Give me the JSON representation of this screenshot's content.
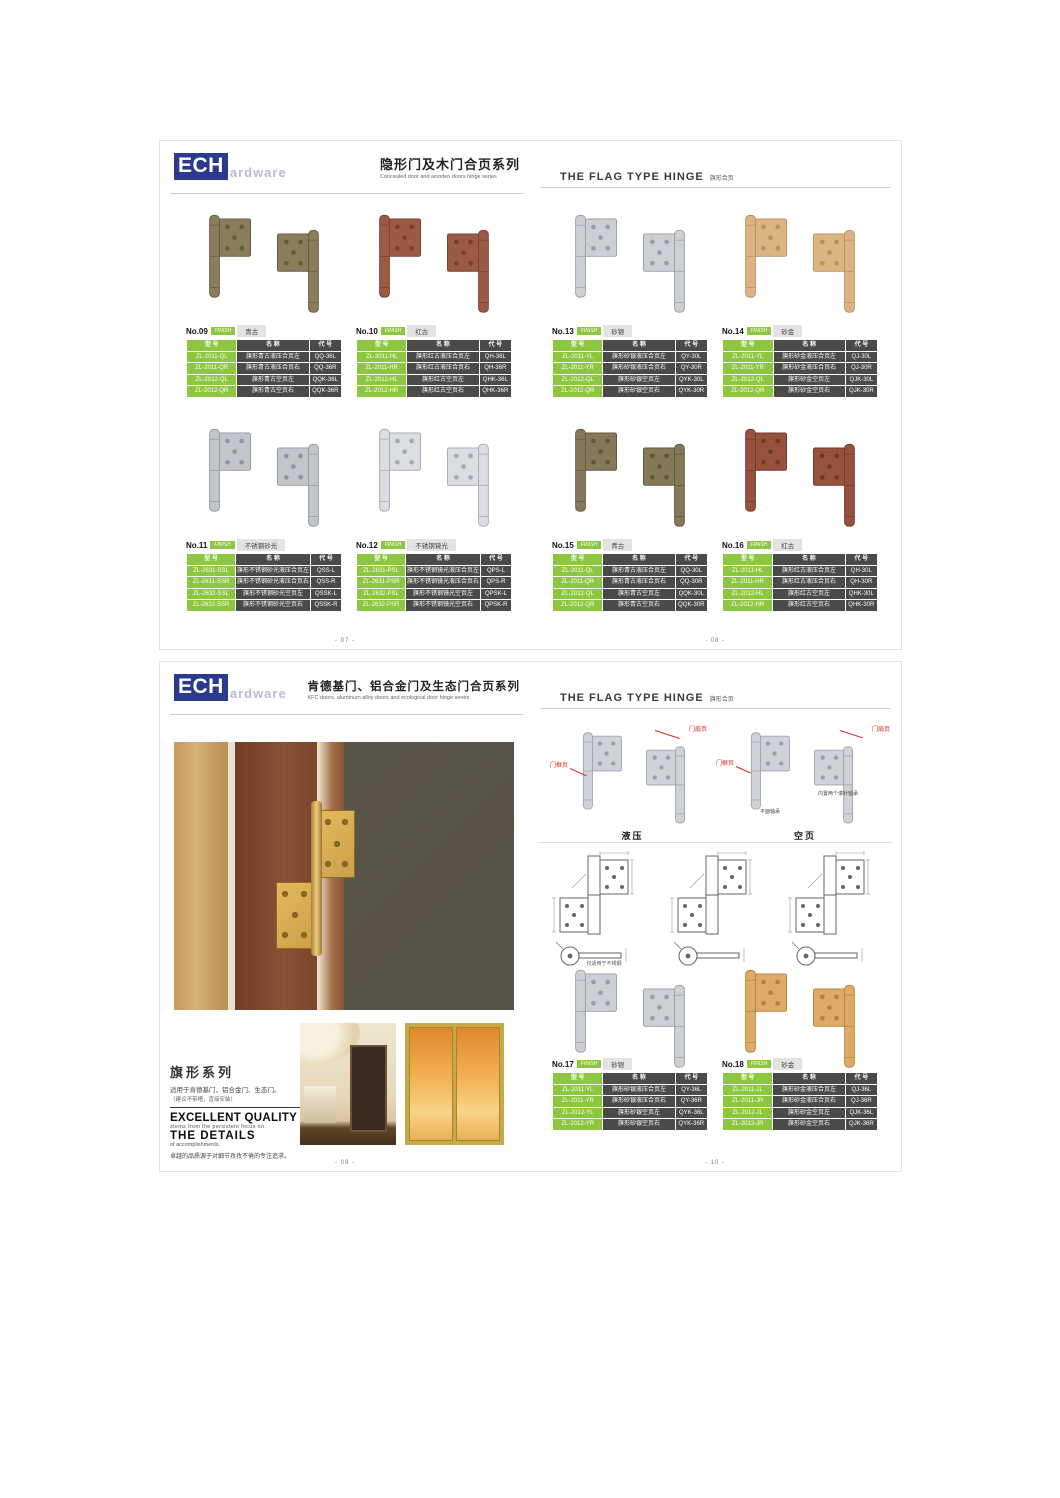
{
  "colors": {
    "green": "#8dc63f",
    "dark_cell": "#4a4a48",
    "navy": "#2b3a8f",
    "red_callout": "#d42b1e",
    "silver": "#cfd3d8",
    "silver_dark": "#9aa0a8"
  },
  "table_headers": [
    "型  号",
    "名  称",
    "代  号"
  ],
  "spread_top": {
    "left_header": {
      "logo_ech": "ECH",
      "logo_rest": "ardware",
      "title_cn": "隐形门及木门合页系列",
      "title_en": "Concealed door and wooden doors hinge series"
    },
    "right_header": {
      "title_en": "THE FLAG TYPE HINGE",
      "title_cn": "旗形合页"
    },
    "page_no_left": "- 07 -",
    "page_no_right": "- 08 -",
    "products": [
      {
        "no": "No.09",
        "finish_badge": "FINISH",
        "finish": "青古",
        "hinge_color": "#8a7d5c",
        "hinge_dark": "#655a3f",
        "rows": [
          [
            "ZL-2011-QL",
            "旗形青古液压合页左",
            "QQ-36L"
          ],
          [
            "ZL-2011-QR",
            "旗形青古液压合页右",
            "QQ-36R"
          ],
          [
            "ZL-2012-QL",
            "旗形青古空页左",
            "QQK-36L"
          ],
          [
            "ZL-2012-QR",
            "旗形青古空页右",
            "QQK-36R"
          ]
        ]
      },
      {
        "no": "No.10",
        "finish_badge": "FINISH",
        "finish": "红古",
        "hinge_color": "#9c5a45",
        "hinge_dark": "#743f2e",
        "rows": [
          [
            "ZL-2011-HL",
            "旗形红古液压合页左",
            "QH-36L"
          ],
          [
            "ZL-2011-HR",
            "旗形红古液压合页右",
            "QH-36R"
          ],
          [
            "ZL-2012-HL",
            "旗形红古空页左",
            "QHK-36L"
          ],
          [
            "ZL-2012-HR",
            "旗形红古空页右",
            "QHK-36R"
          ]
        ]
      },
      {
        "no": "No.13",
        "finish_badge": "FINISH",
        "finish": "砂银",
        "hinge_color": "#ccd0d5",
        "hinge_dark": "#979da5",
        "rows": [
          [
            "ZL-2011-YL",
            "旗形砂银液压合页左",
            "QY-30L"
          ],
          [
            "ZL-2011-YR",
            "旗形砂银液压合页右",
            "QY-30R"
          ],
          [
            "ZL-2012-QL",
            "旗形砂银空页左",
            "QYK-30L"
          ],
          [
            "ZL-2012-QR",
            "旗形砂银空页右",
            "QYK-30R"
          ]
        ]
      },
      {
        "no": "No.14",
        "finish_badge": "FINISH",
        "finish": "砂金",
        "hinge_color": "#dcb481, #b8905c",
        "hinge_dark": "#b8905c",
        "rows": [
          [
            "ZL-2011-YL",
            "旗形砂金液压合页左",
            "QJ-30L"
          ],
          [
            "ZL-2011-YR",
            "旗形砂金液压合页右",
            "QJ-30R"
          ],
          [
            "ZL-2012-QL",
            "旗形砂金空页左",
            "QJK-30L"
          ],
          [
            "ZL-2012-QR",
            "旗形砂金空页右",
            "QJK-30R"
          ]
        ]
      },
      {
        "no": "No.11",
        "finish_badge": "FINISH",
        "finish": "不锈钢砂光",
        "hinge_color": "#c2c6cb",
        "hinge_dark": "#8f959c",
        "rows": [
          [
            "ZL-2631-SSL",
            "旗形不锈钢砂光液压合页左",
            "QSS-L"
          ],
          [
            "ZL-2631-SSR",
            "旗形不锈钢砂光液压合页右",
            "QSS-R"
          ],
          [
            "ZL-2632-SSL",
            "旗形不锈钢砂光空页左",
            "QSSK-L"
          ],
          [
            "ZL-2632-SSR",
            "旗形不锈钢砂光空页右",
            "QSSK-R"
          ]
        ]
      },
      {
        "no": "No.12",
        "finish_badge": "FINISH",
        "finish": "不锈钢镜光",
        "hinge_color": "#dadde1",
        "hinge_dark": "#a4a9b0",
        "rows": [
          [
            "ZL-2631-PSL",
            "旗形不锈钢镜光液压合页左",
            "QPS-L"
          ],
          [
            "ZL-2631-PSR",
            "旗形不锈钢镜光液压合页右",
            "QPS-R"
          ],
          [
            "ZL-2632-PSL",
            "旗形不锈钢镜光空页左",
            "QPSK-L"
          ],
          [
            "ZL-2632-PSR",
            "旗形不锈钢镜光空页右",
            "QPSK-R"
          ]
        ]
      },
      {
        "no": "No.15",
        "finish_badge": "FINISH",
        "finish": "青古",
        "hinge_color": "#85795a",
        "hinge_dark": "#60553c",
        "rows": [
          [
            "ZL-2011-QL",
            "旗形青古液压合页左",
            "QQ-30L"
          ],
          [
            "ZL-2011-QR",
            "旗形青古液压合页右",
            "QQ-30R"
          ],
          [
            "ZL-2012-QL",
            "旗形青古空页左",
            "QQK-30L"
          ],
          [
            "ZL-2012-QR",
            "旗形青古空页右",
            "QQK-30R"
          ]
        ]
      },
      {
        "no": "No.16",
        "finish_badge": "FINISH",
        "finish": "红古",
        "hinge_color": "#96523d",
        "hinge_dark": "#6d392a",
        "rows": [
          [
            "ZL-2011-HL",
            "旗形红古液压合页左",
            "QH-30L"
          ],
          [
            "ZL-2011-HR",
            "旗形红古液压合页右",
            "QH-30R"
          ],
          [
            "ZL-2012-HL",
            "旗形红古空页左",
            "QHK-30L"
          ],
          [
            "ZL-2012-HR",
            "旗形红古空页右",
            "QHK-30R"
          ]
        ]
      }
    ]
  },
  "spread_bottom": {
    "left_header": {
      "logo_ech": "ECH",
      "logo_rest": "ardware",
      "title_cn": "肯德基门、铝合金门及生态门合页系列",
      "title_en": "KFC doors, aluminum alloy doors and ecological door hinge series"
    },
    "right_header": {
      "title_en": "THE FLAG TYPE HINGE",
      "title_cn": "旗形合页"
    },
    "page_no_left": "- 09 -",
    "page_no_right": "- 10 -",
    "series_text": {
      "title": "旗形系列",
      "line1": "适用于肯德基门、铝合金门、生态门。",
      "line2": "（建议不带槽，直接安装）",
      "quality_title": "EXCELLENT QUALITY",
      "quality_sub": "stems from the persistent focus on",
      "details_title": "THE DETAILS",
      "details_sub": "of accomplishments.",
      "cn_line": "卓越的品质源于对细节孜孜不倦的专注追求。"
    },
    "diagram": {
      "hydraulic_caption": "液压",
      "hollow_caption": "空页",
      "label_frame_leaf": "门框页",
      "label_door_leaf": "门扇页",
      "label_plane_bearing": "平面轴承",
      "label_needle_bearing": "内置两个滚针轴承",
      "drawing_note": "仅适用于不锈钢"
    },
    "products": [
      {
        "no": "No.17",
        "finish_badge": "FINISH",
        "finish": "砂银",
        "hinge_color": "#ccd0d5",
        "hinge_dark": "#979da5",
        "rows": [
          [
            "ZL-2011-YL",
            "旗形砂银液压合页左",
            "QY-36L"
          ],
          [
            "ZL-2011-YR",
            "旗形砂银液压合页右",
            "QY-36R"
          ],
          [
            "ZL-2012-YL",
            "旗形砂银空页左",
            "QYK-36L"
          ],
          [
            "ZL-2012-YR",
            "旗形砂银空页右",
            "QYK-36R"
          ]
        ]
      },
      {
        "no": "No.18",
        "finish_badge": "FINISH",
        "finish": "砂金",
        "hinge_color": "#ddab66",
        "hinge_dark": "#b5813f",
        "rows": [
          [
            "ZL-2011-JL",
            "旗形砂金液压合页左",
            "QJ-36L"
          ],
          [
            "ZL-2011-JR",
            "旗形砂金液压合页右",
            "QJ-36R"
          ],
          [
            "ZL-2012-JL",
            "旗形砂金空页左",
            "QJK-36L"
          ],
          [
            "ZL-2012-JR",
            "旗形砂金空页右",
            "QJK-36R"
          ]
        ]
      }
    ]
  }
}
